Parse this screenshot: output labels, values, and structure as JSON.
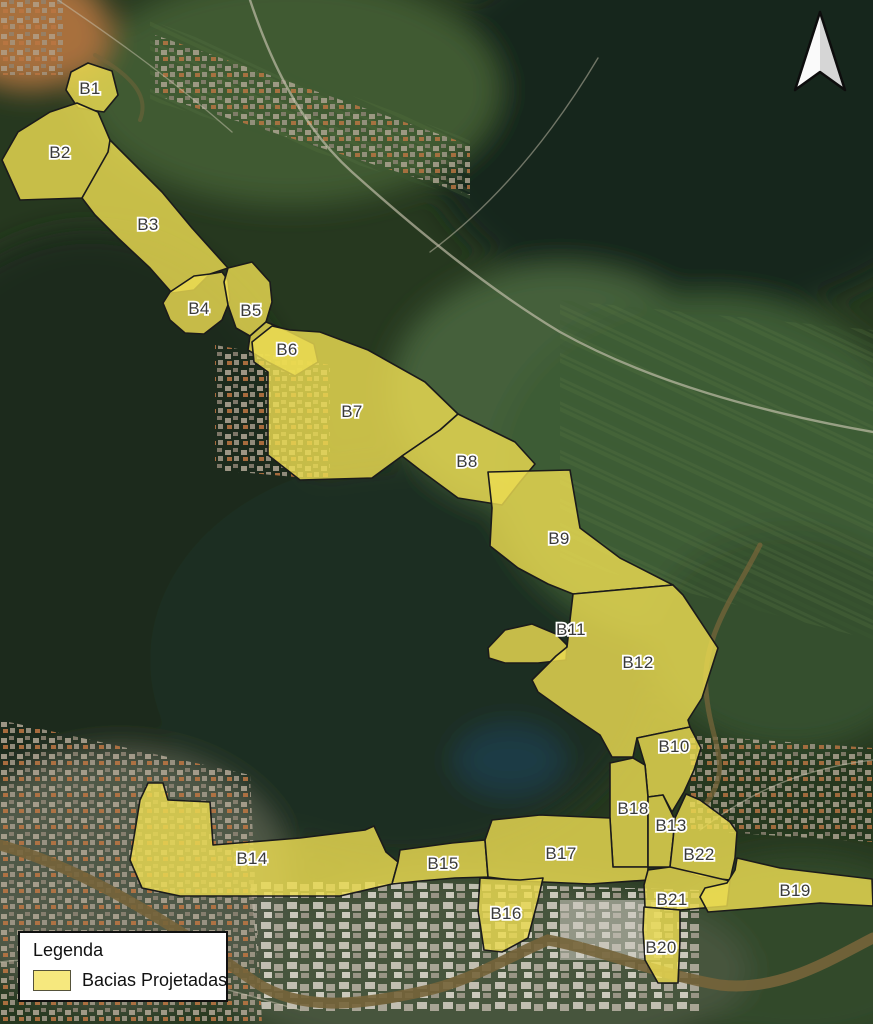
{
  "map": {
    "basins": [
      {
        "id": "B1",
        "label": "B1"
      },
      {
        "id": "B2",
        "label": "B2"
      },
      {
        "id": "B3",
        "label": "B3"
      },
      {
        "id": "B4",
        "label": "B4"
      },
      {
        "id": "B5",
        "label": "B5"
      },
      {
        "id": "B6",
        "label": "B6"
      },
      {
        "id": "B7",
        "label": "B7"
      },
      {
        "id": "B8",
        "label": "B8"
      },
      {
        "id": "B9",
        "label": "B9"
      },
      {
        "id": "B10",
        "label": "B10"
      },
      {
        "id": "B11",
        "label": "B11"
      },
      {
        "id": "B12",
        "label": "B12"
      },
      {
        "id": "B13",
        "label": "B13"
      },
      {
        "id": "B14",
        "label": "B14"
      },
      {
        "id": "B15",
        "label": "B15"
      },
      {
        "id": "B16",
        "label": "B16"
      },
      {
        "id": "B17",
        "label": "B17"
      },
      {
        "id": "B18",
        "label": "B18"
      },
      {
        "id": "B19",
        "label": "B19"
      },
      {
        "id": "B20",
        "label": "B20"
      },
      {
        "id": "B21",
        "label": "B21"
      },
      {
        "id": "B22",
        "label": "B22"
      }
    ],
    "legend": {
      "title": "Legenda",
      "items": [
        {
          "label": "Bacias Projetadas",
          "swatch_color": "#f6e87e"
        }
      ]
    },
    "colors": {
      "basin_fill": "#ecdc52",
      "basin_stroke": "#1b1b1b",
      "label_text": "#3a3a3a",
      "label_halo": "#ffffff",
      "forest_dark": "#1a2c1c",
      "farmland_green": "#44603a",
      "river_brown": "#75643a"
    }
  }
}
